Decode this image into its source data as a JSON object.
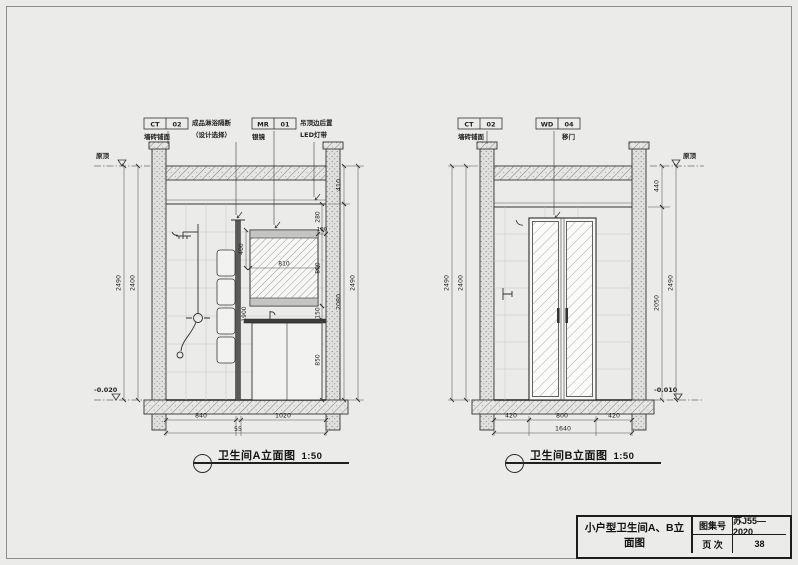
{
  "page": {
    "background": "#ebebe9",
    "line_color": "#333333"
  },
  "title_block": {
    "title": "小户型卫生间A、B立面图",
    "atlas_label": "图集号",
    "atlas_value": "苏J55—2020",
    "page_label": "页 次",
    "page_value": "38"
  },
  "elevation_a": {
    "caption": "卫生间A立面图",
    "scale": "1:50",
    "callouts": {
      "ct_code": "CT",
      "ct_num": "02",
      "ct_label": "墙砖铺面",
      "partition_line1": "成品淋浴隔断",
      "partition_line2": "（设计选择）",
      "mr_code": "MR",
      "mr_num": "01",
      "mr_label": "银镜",
      "led_line1": "吊顶边后置",
      "led_line2": "LED灯带"
    },
    "levels": {
      "top": "原顶",
      "bottom": "-0.020"
    },
    "dims": {
      "left_inner": "2400",
      "left_outer": "2490",
      "right_top": "410",
      "right_mid": "2080",
      "right_total": "2490",
      "bottom": [
        "840",
        "55",
        "1020"
      ],
      "mirror_width": "810",
      "mirror_gap": "100",
      "mirror_top": "400",
      "stack": [
        "280",
        "800",
        "150",
        "850"
      ],
      "partition_height": "1900"
    }
  },
  "elevation_b": {
    "caption": "卫生间B立面图",
    "scale": "1:50",
    "callouts": {
      "ct_code": "CT",
      "ct_num": "02",
      "ct_label": "墙砖铺面",
      "wd_code": "WD",
      "wd_num": "04",
      "wd_label": "移门"
    },
    "levels": {
      "top": "原顶",
      "bottom": "-0.010"
    },
    "dims": {
      "left_inner": "2400",
      "left_outer": "2490",
      "right_top": "440",
      "right_mid": "2050",
      "right_total": "2490",
      "bottom": [
        "420",
        "800",
        "420"
      ],
      "bottom_total": "1640"
    }
  }
}
